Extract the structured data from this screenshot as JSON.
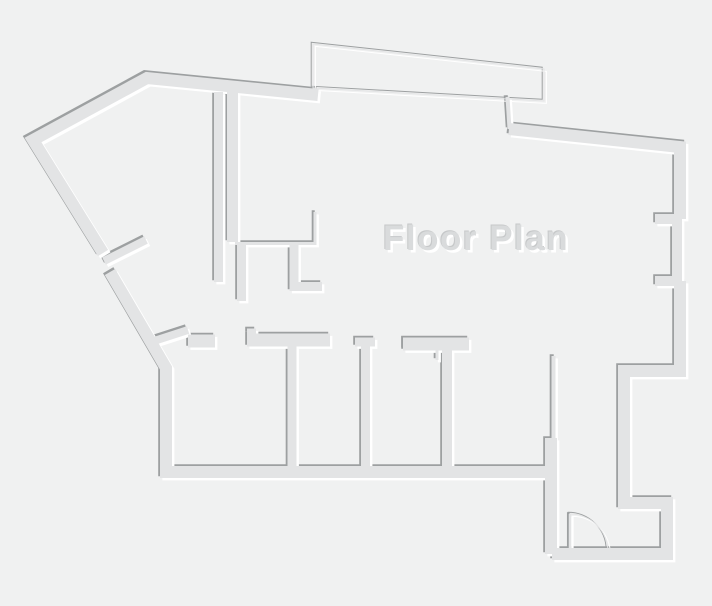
{
  "title": "Floor Plan",
  "canvas": {
    "width": "712",
    "height": "606"
  },
  "palette": {
    "background": "#f0f1f1",
    "wall_fill": "#e3e4e5",
    "wall_shadow": "#9da0a1",
    "wall_highlight": "#ffffff",
    "title_color": "#d9dbdc"
  },
  "features": [
    "outer-boundary-walls",
    "top-protrusion-wall",
    "left-diagonal-door-opening",
    "corridor-walls",
    "interior-thin-walls",
    "bottom-room-partitions",
    "right-wall-door-jambs",
    "entry-door-swing-arc"
  ]
}
